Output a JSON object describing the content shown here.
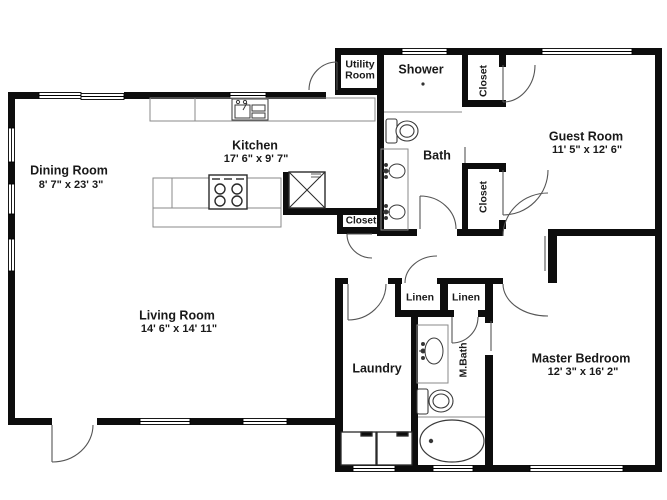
{
  "title": "Floor Plan",
  "rooms": {
    "dining": {
      "name": "Dining Room",
      "dims": "8' 7\" x 23' 3\""
    },
    "kitchen": {
      "name": "Kitchen",
      "dims": "17' 6\" x 9' 7\""
    },
    "living": {
      "name": "Living Room",
      "dims": "14' 6\" x 14' 11\""
    },
    "guest": {
      "name": "Guest Room",
      "dims": "11' 5\" x 12' 6\""
    },
    "master": {
      "name": "Master Bedroom",
      "dims": "12' 3\" x 16' 2\""
    },
    "utility": {
      "name": "Utility Room"
    },
    "shower": {
      "name": "Shower"
    },
    "bath": {
      "name": "Bath"
    },
    "mbath": {
      "name": "M.Bath"
    },
    "laundry": {
      "name": "Laundry"
    },
    "closet_kitchen": {
      "name": "Closet"
    },
    "closet_guest_upper": {
      "name": "Closet"
    },
    "closet_guest_lower": {
      "name": "Closet"
    },
    "linen_left": {
      "name": "Linen"
    },
    "linen_right": {
      "name": "Linen"
    }
  },
  "colors": {
    "wall": "#0d0d0d",
    "fixture_line": "#3a3a3a",
    "counter_line": "#8a8a8a",
    "door_line": "#555555",
    "background": "#ffffff",
    "text": "#191919"
  }
}
